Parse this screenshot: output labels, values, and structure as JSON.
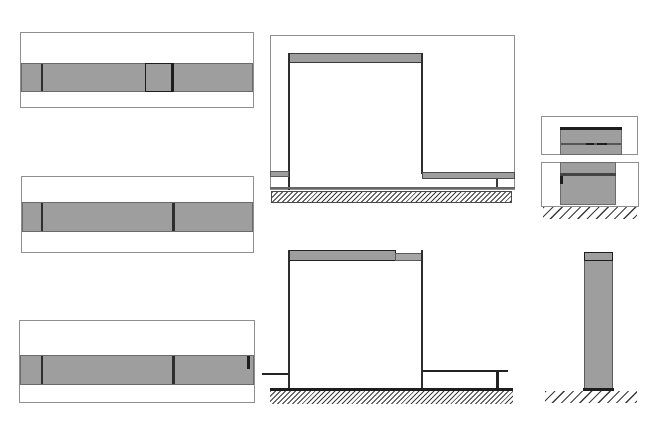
{
  "canvas": {
    "width": 670,
    "height": 422,
    "background": "#ffffff"
  },
  "palette": {
    "fill_gray": "#9e9e9e",
    "fill_gray_light": "#a6a6a6",
    "line_dark": "#1d1d1d",
    "line_wall": "#2e2e2e",
    "line_mid": "#555555",
    "band_edge": "#6a6a6a",
    "frame_border": "#8f8f8f",
    "hatch_line": "#3a3a3a",
    "background": "#ffffff"
  },
  "views": [
    {
      "name": "plan-view-top",
      "shapes": [
        {
          "name": "view-frame",
          "type": "rect",
          "x": 20,
          "y": 32,
          "w": 234,
          "h": 76,
          "fill": "#ffffff",
          "stroke": "#8f8f8f",
          "sw": 1
        },
        {
          "name": "wall-band",
          "type": "rect",
          "x": 21,
          "y": 63,
          "w": 232,
          "h": 29,
          "fill": "#9e9e9e",
          "stroke": "#6a6a6a",
          "sw": 1
        },
        {
          "name": "band-divider-line",
          "type": "rect",
          "x": 41,
          "y": 64,
          "w": 2,
          "h": 27,
          "fill": "#2e2e2e"
        },
        {
          "name": "module-outline",
          "type": "rect",
          "x": 145,
          "y": 63,
          "w": 29,
          "h": 29,
          "fill": "none",
          "stroke": "#1d1d1d",
          "sw": 1.5
        },
        {
          "name": "module-right-edge",
          "type": "rect",
          "x": 171,
          "y": 63,
          "w": 3,
          "h": 29,
          "fill": "#1d1d1d"
        }
      ]
    },
    {
      "name": "plan-view-middle",
      "shapes": [
        {
          "name": "view-frame",
          "type": "rect",
          "x": 21,
          "y": 176,
          "w": 233,
          "h": 77,
          "fill": "#ffffff",
          "stroke": "#8f8f8f",
          "sw": 1
        },
        {
          "name": "wall-band",
          "type": "rect",
          "x": 22,
          "y": 202,
          "w": 231,
          "h": 30,
          "fill": "#9e9e9e",
          "stroke": "#6a6a6a",
          "sw": 1
        },
        {
          "name": "band-divider-line-left",
          "type": "rect",
          "x": 41,
          "y": 203,
          "w": 2,
          "h": 28,
          "fill": "#2e2e2e"
        },
        {
          "name": "band-divider-line-right",
          "type": "rect",
          "x": 172,
          "y": 203,
          "w": 2.5,
          "h": 28,
          "fill": "#2e2e2e"
        }
      ]
    },
    {
      "name": "plan-view-bottom",
      "shapes": [
        {
          "name": "view-frame",
          "type": "rect",
          "x": 19,
          "y": 320,
          "w": 236,
          "h": 83,
          "fill": "#ffffff",
          "stroke": "#8f8f8f",
          "sw": 1
        },
        {
          "name": "wall-band",
          "type": "rect",
          "x": 20,
          "y": 355,
          "w": 234,
          "h": 30,
          "fill": "#9e9e9e",
          "stroke": "#6a6a6a",
          "sw": 1
        },
        {
          "name": "band-divider-line-left",
          "type": "rect",
          "x": 41,
          "y": 356,
          "w": 2,
          "h": 28,
          "fill": "#2e2e2e"
        },
        {
          "name": "band-divider-line-right",
          "type": "rect",
          "x": 172,
          "y": 356,
          "w": 2.5,
          "h": 28,
          "fill": "#2e2e2e"
        },
        {
          "name": "band-end-tick",
          "type": "rect",
          "x": 247,
          "y": 356,
          "w": 2.5,
          "h": 13,
          "fill": "#1d1d1d"
        }
      ]
    },
    {
      "name": "elevation-front",
      "shapes": [
        {
          "name": "view-frame",
          "type": "rect",
          "x": 270,
          "y": 35,
          "w": 245,
          "h": 155,
          "fill": "none",
          "stroke": "#8f8f8f",
          "sw": 1
        },
        {
          "name": "top-beam",
          "type": "rect",
          "x": 288,
          "y": 53,
          "w": 135,
          "h": 10,
          "fill": "#9e9e9e",
          "stroke": "#3a3a3a",
          "sw": 1.5
        },
        {
          "name": "left-wall-line",
          "type": "rect",
          "x": 288,
          "y": 53,
          "w": 2,
          "h": 137,
          "fill": "#2e2e2e"
        },
        {
          "name": "right-wall-line",
          "type": "rect",
          "x": 421,
          "y": 53,
          "w": 2,
          "h": 121,
          "fill": "#2e2e2e"
        },
        {
          "name": "left-counter",
          "type": "rect",
          "x": 270,
          "y": 171,
          "w": 19,
          "h": 6,
          "fill": "#9e9e9e",
          "stroke": "#5a5a5a",
          "sw": 1
        },
        {
          "name": "right-counter",
          "type": "rect",
          "x": 422,
          "y": 172,
          "w": 93,
          "h": 7,
          "fill": "#9e9e9e",
          "stroke": "#4a4a4a",
          "sw": 1
        },
        {
          "name": "right-counter-leg",
          "type": "rect",
          "x": 496,
          "y": 179,
          "w": 2,
          "h": 10,
          "fill": "#3a3a3a"
        },
        {
          "name": "floor-line",
          "type": "rect",
          "x": 270,
          "y": 187,
          "w": 245,
          "h": 1.5,
          "fill": "#666666"
        },
        {
          "name": "ground-hatch",
          "type": "hatch",
          "pattern": "dense",
          "x": 271,
          "y": 191,
          "w": 241,
          "h": 12,
          "stroke": "#4a4a4a",
          "sw": 1
        }
      ]
    },
    {
      "name": "elevation-section",
      "shapes": [
        {
          "name": "top-beam-left",
          "type": "rect",
          "x": 288,
          "y": 250,
          "w": 108,
          "h": 11,
          "fill": "#9e9e9e",
          "stroke": "#222222",
          "sw": 1.5
        },
        {
          "name": "top-beam-right",
          "type": "rect",
          "x": 395,
          "y": 253,
          "w": 28,
          "h": 8,
          "fill": "#a6a6a6",
          "stroke": "#5a5a5a",
          "sw": 1
        },
        {
          "name": "left-wall-line",
          "type": "rect",
          "x": 288,
          "y": 250,
          "w": 2,
          "h": 139,
          "fill": "#2e2e2e"
        },
        {
          "name": "right-wall-line",
          "type": "rect",
          "x": 421,
          "y": 250,
          "w": 2,
          "h": 139,
          "fill": "#2e2e2e"
        },
        {
          "name": "left-counter-line",
          "type": "rect",
          "x": 262,
          "y": 373,
          "w": 26,
          "h": 2,
          "fill": "#222222"
        },
        {
          "name": "right-counter-line",
          "type": "rect",
          "x": 423,
          "y": 370,
          "w": 85,
          "h": 2,
          "fill": "#222222"
        },
        {
          "name": "right-counter-leg",
          "type": "rect",
          "x": 496,
          "y": 370,
          "w": 2.5,
          "h": 19,
          "fill": "#222222"
        },
        {
          "name": "ground-line",
          "type": "rect",
          "x": 270,
          "y": 388,
          "w": 243,
          "h": 3,
          "fill": "#1d1d1d"
        },
        {
          "name": "ground-hatch",
          "type": "hatch",
          "pattern": "dense",
          "x": 270,
          "y": 391,
          "w": 243,
          "h": 13
        }
      ]
    },
    {
      "name": "detail-section-upper",
      "shapes": [
        {
          "name": "view-frame",
          "type": "rect",
          "x": 541,
          "y": 116,
          "w": 97,
          "h": 39,
          "fill": "#ffffff",
          "stroke": "#8f8f8f",
          "sw": 1
        },
        {
          "name": "cabinet-block",
          "type": "rect",
          "x": 560,
          "y": 127,
          "w": 62,
          "h": 28,
          "fill": "#9e9e9e",
          "stroke": "#6a6a6a",
          "sw": 1
        },
        {
          "name": "cabinet-top-edge",
          "type": "rect",
          "x": 560,
          "y": 127,
          "w": 62,
          "h": 3,
          "fill": "#1d1d1d"
        },
        {
          "name": "shelf-line",
          "type": "rect",
          "x": 561,
          "y": 143,
          "w": 60,
          "h": 2,
          "fill": "#555555"
        },
        {
          "name": "shelf-dash-left",
          "type": "rect",
          "x": 586,
          "y": 143,
          "w": 8,
          "h": 2,
          "fill": "#1d1d1d"
        },
        {
          "name": "shelf-dash-right",
          "type": "rect",
          "x": 597,
          "y": 142.5,
          "w": 10,
          "h": 2,
          "fill": "#1d1d1d"
        }
      ]
    },
    {
      "name": "detail-section-lower",
      "shapes": [
        {
          "name": "view-frame",
          "type": "rect",
          "x": 541,
          "y": 162,
          "w": 98,
          "h": 45,
          "fill": "#ffffff",
          "stroke": "#8f8f8f",
          "sw": 1
        },
        {
          "name": "cabinet-block",
          "type": "rect",
          "x": 560,
          "y": 162,
          "w": 56,
          "h": 43,
          "fill": "#9e9e9e",
          "stroke": "#6a6a6a",
          "sw": 1
        },
        {
          "name": "shelf-line",
          "type": "rect",
          "x": 560,
          "y": 173,
          "w": 56,
          "h": 2.5,
          "fill": "#444444"
        },
        {
          "name": "handle-mark",
          "type": "rect",
          "x": 560,
          "y": 176,
          "w": 3,
          "h": 8,
          "fill": "#1d1d1d"
        },
        {
          "name": "ground-hatch",
          "type": "hatch",
          "pattern": "sparse",
          "x": 543,
          "y": 207,
          "w": 94,
          "h": 12
        }
      ]
    },
    {
      "name": "pillar-side-view",
      "shapes": [
        {
          "name": "pillar-body",
          "type": "rect",
          "x": 584,
          "y": 252,
          "w": 29,
          "h": 138,
          "fill": "#9e9e9e",
          "stroke": "#5a5a5a",
          "sw": 1
        },
        {
          "name": "pillar-cap",
          "type": "rect",
          "x": 584,
          "y": 252,
          "w": 29,
          "h": 9,
          "fill": "#9e9e9e",
          "stroke": "#1d1d1d",
          "sw": 1.5
        },
        {
          "name": "pillar-base-line",
          "type": "rect",
          "x": 583,
          "y": 388,
          "w": 31,
          "h": 3,
          "fill": "#1d1d1d"
        },
        {
          "name": "ground-hatch",
          "type": "hatch",
          "pattern": "sparse",
          "x": 545,
          "y": 391,
          "w": 92,
          "h": 12
        }
      ]
    }
  ]
}
